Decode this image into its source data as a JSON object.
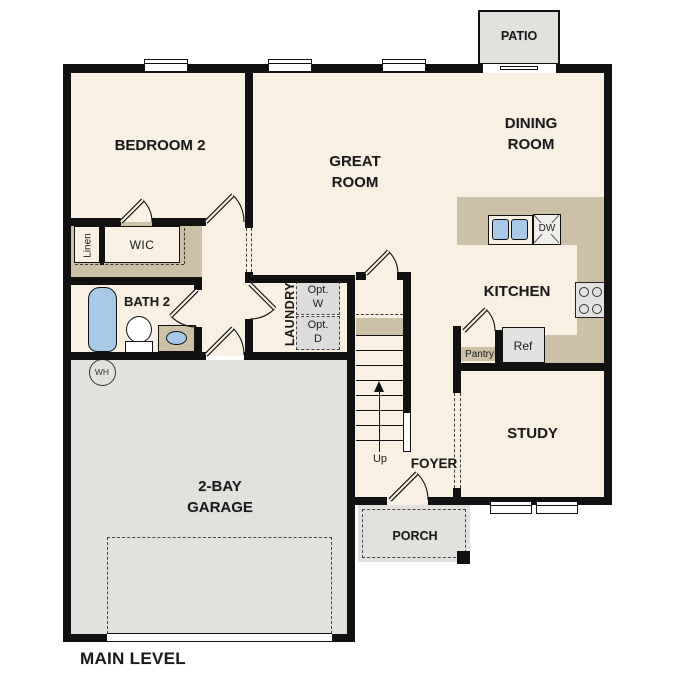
{
  "title": "MAIN LEVEL",
  "colors": {
    "wall": "#111111",
    "floor": "#f7f0e3",
    "counter": "#ccc0a6",
    "exterior": "#e2e1de",
    "fixture": "#a9c9e9",
    "appliance": "#e3e2e0",
    "ink": "#1a1a1a"
  },
  "rooms": {
    "bedroom2": "BEDROOM 2",
    "great_room": "GREAT\nROOM",
    "dining_room": "DINING\nROOM",
    "kitchen": "KITCHEN",
    "study": "STUDY",
    "foyer": "FOYER",
    "laundry": "LAUNDRY",
    "garage": "2-BAY\nGARAGE",
    "bath2": "BATH 2",
    "wic": "WIC",
    "linen": "Linen",
    "pantry": "Pantry"
  },
  "outdoor": {
    "patio": "PATIO",
    "porch": "PORCH"
  },
  "fixtures": {
    "ref": "Ref",
    "dishwasher": "DW",
    "opt_washer": "Opt.\nW",
    "opt_dryer": "Opt.\nD",
    "water_heater": "WH",
    "stairs_up": "Up"
  }
}
